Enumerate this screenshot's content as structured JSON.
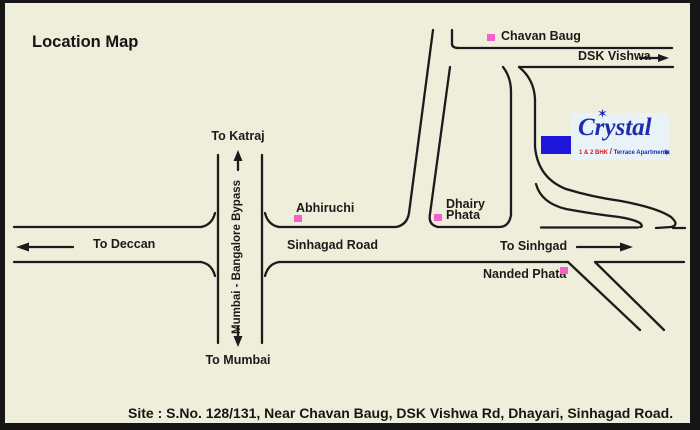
{
  "title": "Location Map",
  "roads": {
    "bypass_label": "Mumbai - Bangalore Bypass",
    "sinhagad_label": "Sinhagad Road"
  },
  "directions": {
    "katraj": "To Katraj",
    "mumbai": "To Mumbai",
    "deccan": "To Deccan",
    "sinhgad": "To Sinhgad",
    "dsk_vishwa": "DSK Vishwa"
  },
  "landmarks": {
    "chavan_baug": "Chavan Baug",
    "abhiruchi": "Abhiruchi",
    "dhairy_phata_line1": "Dhairy",
    "dhairy_phata_line2": "Phata",
    "nanded_phata": "Nanded Phata"
  },
  "site": {
    "logo_name": "Crystal",
    "logo_sub_left": "1 & 2 BHK",
    "logo_sub_slash": "/",
    "logo_sub_right": "Terrace Apartments",
    "sparkle": "✶"
  },
  "footer": {
    "site_address": "Site : S.No. 128/131, Near Chavan Baug, DSK Vishwa Rd, Dhayari, Sinhagad Road."
  },
  "colors": {
    "background": "#efeeda",
    "road_ink": "#1b1b1b",
    "landmark_pink": "#f263c8",
    "site_blue": "#1e16d9",
    "logo_blue": "#1c2db0",
    "logo_red": "#cc1f1f",
    "logo_panel": "#e9f2f6"
  }
}
